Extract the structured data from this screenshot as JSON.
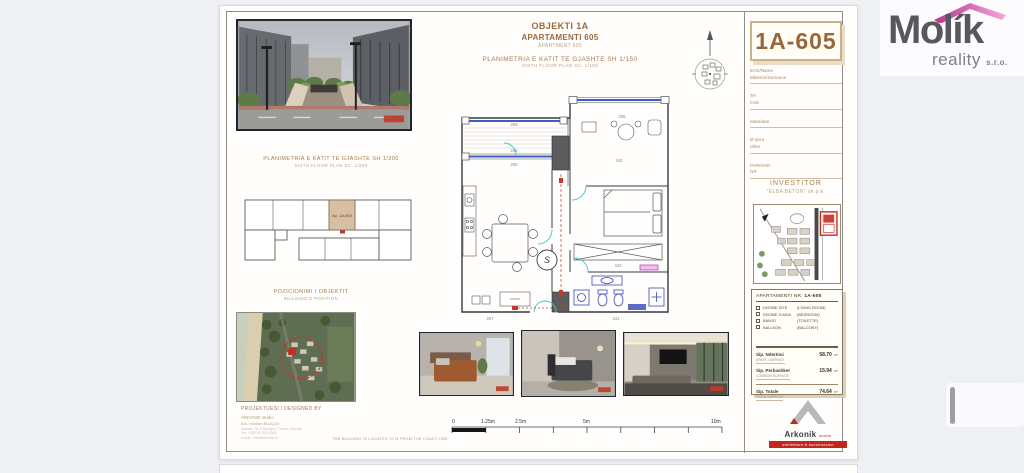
{
  "colors": {
    "accent_brown": "#9b6a3f",
    "highlight_tan": "#d7c0a2",
    "plan_blue": "#3a5fc8",
    "door_cyan": "#3cc8d0",
    "marker_red": "#c0392b",
    "molik_gray": "#57585b",
    "molik_pink": "#d9539e",
    "arkonik_red": "#c0281e",
    "background": "#eef0f4"
  },
  "brand": {
    "name": "Molík",
    "word2": "reality",
    "word3": "s.r.o."
  },
  "header": {
    "project": "OBJEKTI 1A",
    "apartment": "APARTAMENTI 605",
    "apartment_en": "APARTMENT 605",
    "plan_title": "PLANIMETRIA E KATIT TE GJASHTE SH 1/150",
    "plan_title_en": "SIXTH FLOOR PLAN   SC. 1/150"
  },
  "unit_tag": "1A-605",
  "client_form": {
    "fields": [
      {
        "line1": "Emri/Name",
        "line2": "Mbiemri/Surname"
      },
      {
        "line1": "Tel",
        "line2": "mob"
      },
      {
        "line1": "data/date",
        "line2": ""
      },
      {
        "line1": "të tjera",
        "line2": "other"
      },
      {
        "line1": "PARKING",
        "line2": "NR"
      }
    ]
  },
  "investor": {
    "label": "INVESTITOR",
    "name": "“ELBA BETON” sh.p.k."
  },
  "keyplan": {
    "title": "PLANIMETRIA E KATIT TE GJASHTE SH 1/200",
    "title_en": "SIXTH FLOOR PLAN   SC. 1/200",
    "unit": "Ap. 1A-605"
  },
  "position": {
    "title": "POZICIONIMI I OBJEKTIT",
    "title_en": "BUILDING'S POSITION"
  },
  "designer": {
    "label": "PROJEKTUESI / DESIGNED BY",
    "studio": "ARKONIK studio",
    "architect": "Ark. Klodian BUJQJA",
    "line1": "Adresa: Rr. e Kavajes, Tirane, Albania",
    "line2": "Tel: +355 69 200 0000",
    "line3": "e-mail: info@arkonik.al",
    "note": "THE BUILDING IS LOCATED 70 M FROM THE COAST LINE."
  },
  "card": {
    "title": "APARTAMENTI NR.",
    "code": "1A-605",
    "rooms": [
      {
        "sq": "DHOME DITE",
        "en": "(LIVING ROOM)"
      },
      {
        "sq": "DHOME GJUMI",
        "en": "(BEDROOM)"
      },
      {
        "sq": "BANJO",
        "en": "(TOILETTE)"
      },
      {
        "sq": "BALLKON",
        "en": "(BALCONY)"
      }
    ],
    "surfaces": [
      {
        "label": "Sip. Ndertimi",
        "sub": "APART. SURFACE",
        "value": "58.70",
        "unit": "m²"
      },
      {
        "label": "Sip. Perbashket",
        "sub": "COMMON SURFACE",
        "value": "15.94",
        "unit": "m²"
      },
      {
        "label": "Sip. Totale",
        "sub": "TOTAL SURFACE",
        "value": "74.64",
        "unit": "m²"
      }
    ]
  },
  "scalebar": {
    "labels": [
      "0",
      "1.25m",
      "2.5m",
      "5m",
      "10m"
    ]
  },
  "plan": {
    "dims": {
      "top_balcony": "259",
      "window": "256",
      "interior": "256",
      "topright": "255",
      "right_room": "342",
      "bed_width": "342",
      "bath_width": "341",
      "kitchen": "257"
    },
    "stair": "S"
  },
  "arkonik": {
    "name": "Arkonik",
    "suffix": "studio",
    "banner": "arkitekture & konstruksion"
  }
}
